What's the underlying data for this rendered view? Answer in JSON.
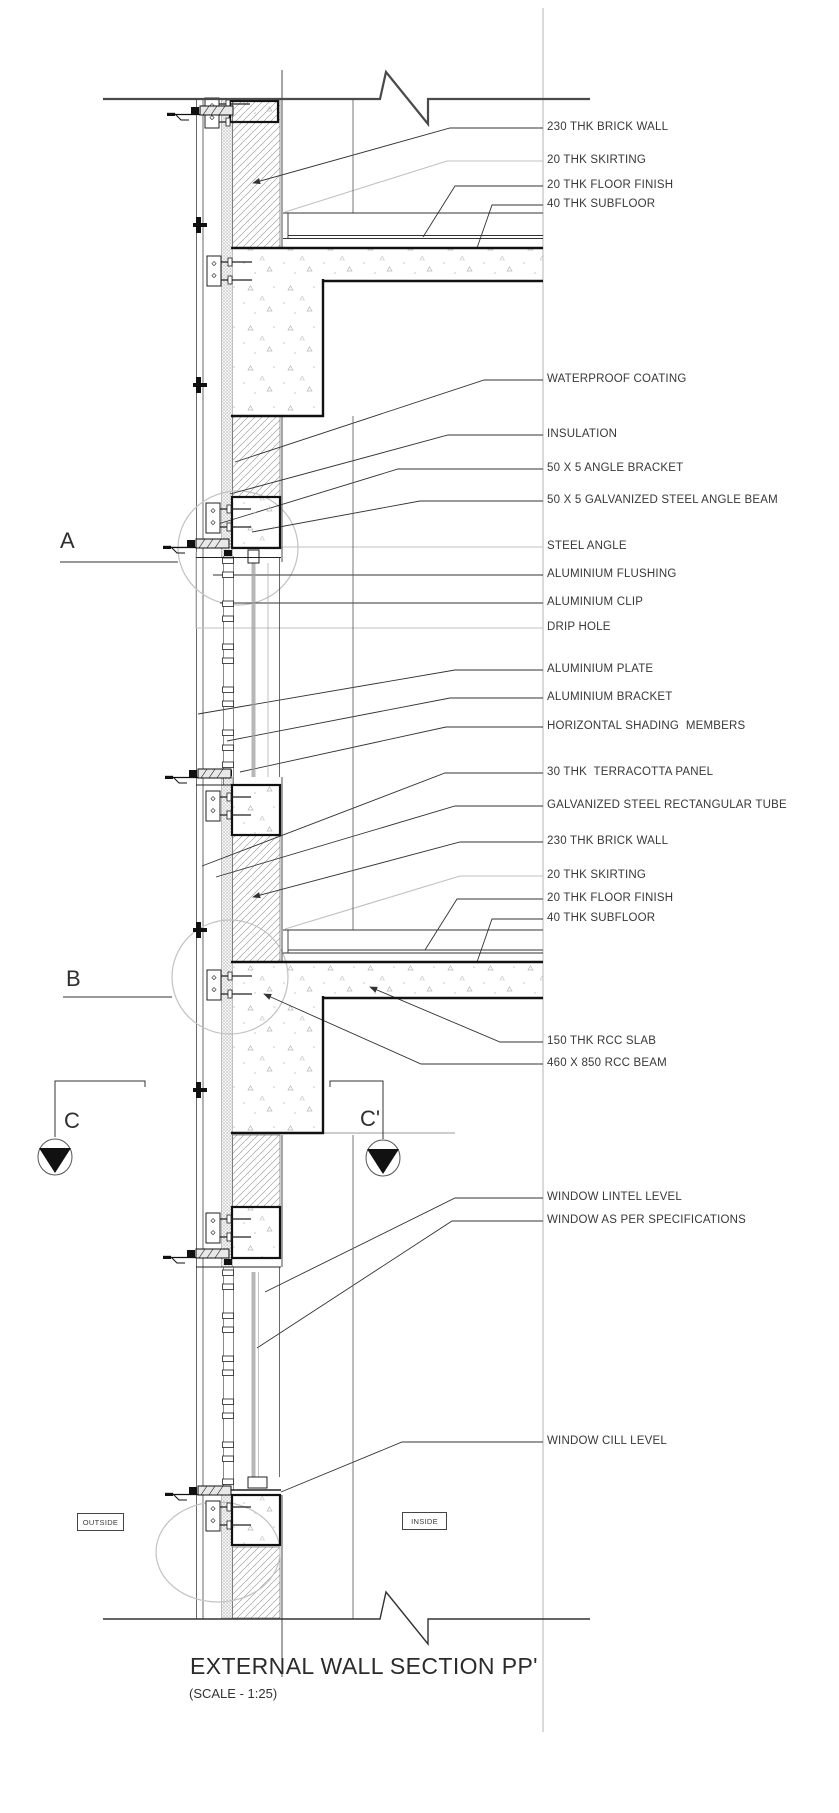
{
  "drawing": {
    "title": "EXTERNAL WALL SECTION PP'",
    "scale_note": "(SCALE - 1:25)",
    "region_labels": {
      "outside": "OUTSIDE",
      "inside": "INSIDE"
    },
    "section_markers": {
      "a": "A",
      "b": "B",
      "c": "C",
      "c_prime": "C'"
    },
    "callouts": [
      {
        "text": "230 THK BRICK WALL"
      },
      {
        "text": "20 THK SKIRTING"
      },
      {
        "text": "20 THK FLOOR FINISH"
      },
      {
        "text": "40 THK SUBFLOOR"
      },
      {
        "text": "WATERPROOF COATING"
      },
      {
        "text": "INSULATION"
      },
      {
        "text": "50 X 5 ANGLE BRACKET"
      },
      {
        "text": "50 X 5 GALVANIZED STEEL ANGLE BEAM"
      },
      {
        "text": "STEEL ANGLE"
      },
      {
        "text": "ALUMINIUM FLUSHING"
      },
      {
        "text": "ALUMINIUM CLIP"
      },
      {
        "text": "DRIP HOLE"
      },
      {
        "text": "ALUMINIUM PLATE"
      },
      {
        "text": "ALUMINIUM BRACKET"
      },
      {
        "text": "HORIZONTAL SHADING  MEMBERS"
      },
      {
        "text": "30 THK  TERRACOTTA PANEL"
      },
      {
        "text": "GALVANIZED STEEL RECTANGULAR TUBE"
      },
      {
        "text": "230 THK BRICK WALL"
      },
      {
        "text": "20 THK SKIRTING"
      },
      {
        "text": "20 THK FLOOR FINISH"
      },
      {
        "text": "40 THK SUBFLOOR"
      },
      {
        "text": "150 THK RCC SLAB"
      },
      {
        "text": "460 X 850 RCC BEAM"
      },
      {
        "text": "WINDOW LINTEL LEVEL"
      },
      {
        "text": "WINDOW AS PER SPECIFICATIONS"
      },
      {
        "text": "WINDOW CILL LEVEL"
      }
    ],
    "colors": {
      "line": "#3a3a3a",
      "heavy_line": "#111111",
      "grey_leader": "#c0c0c0",
      "concrete_stipple": "#b8b8b8",
      "text": "#383838"
    }
  }
}
